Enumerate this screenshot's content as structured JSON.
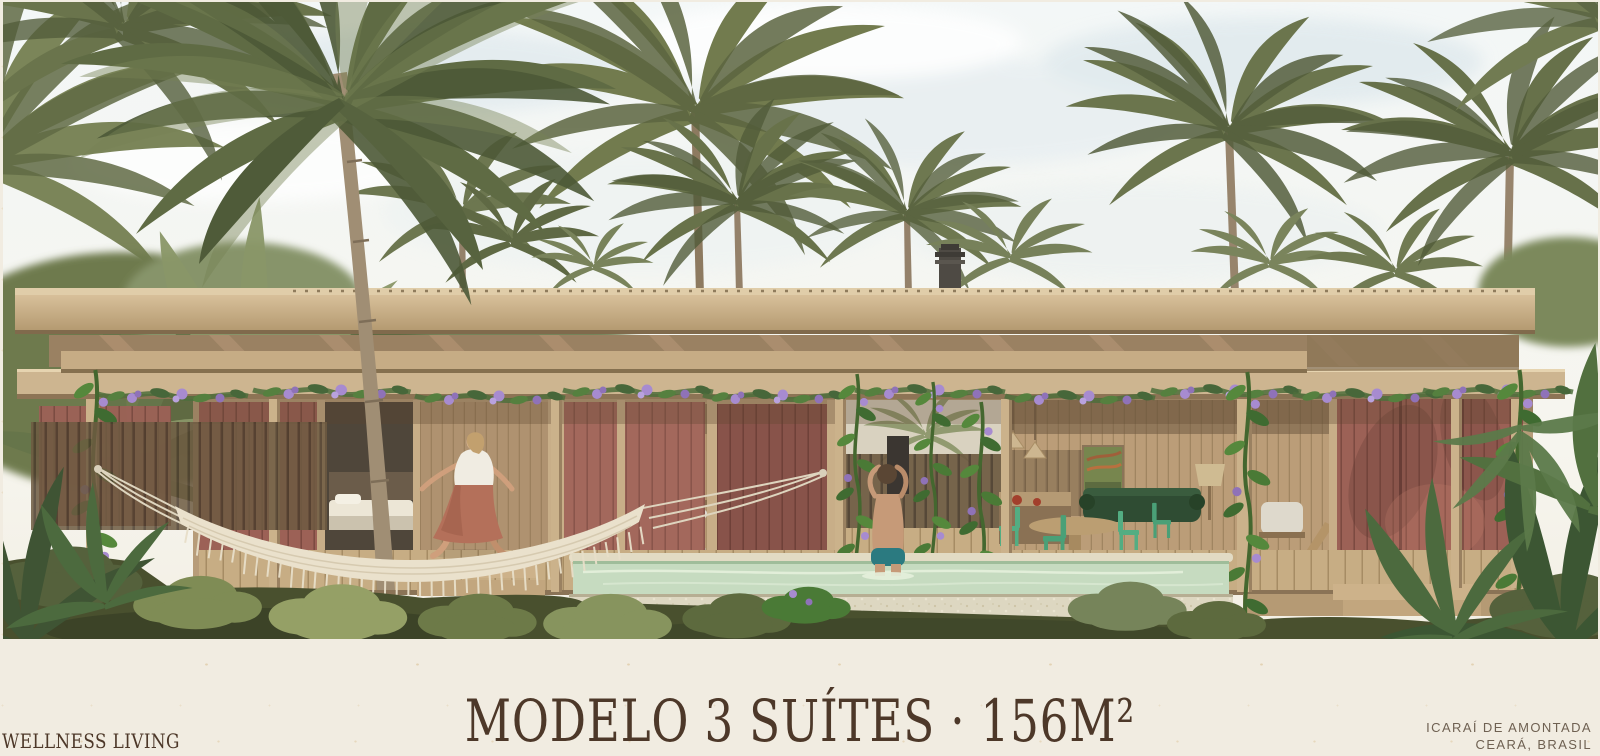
{
  "slide": {
    "title": "MODELO 3 SUÍTES · 156M²",
    "brand": "WELLNESS LIVING",
    "location": {
      "line1": "ICARAÍ DE AMONTADA",
      "line2": "CEARÁ, BRASIL"
    },
    "hero_alt": "Architectural rendering of a single-storey timber house with a flat pergola roof, terracotta sliding panels, flowering vines, a lap pool with a child bathing, a woman walking on the wooden deck, a white macrame hammock and coconut palms under a pale sky"
  },
  "colors": {
    "paper": "#f1ece1",
    "ink": "#4d3829",
    "ink-soft": "#6f6152",
    "sky": "#f5f8f7",
    "wood-light": "#d8c09a",
    "wood": "#c0a67f",
    "wood-dark": "#8f7758",
    "terracotta": "#9c6156",
    "terracotta-dark": "#7c4a41",
    "palm-olive": "#6d7750",
    "palm-dark": "#515c3a",
    "jungle": "#5e6a42",
    "grass": "#49502e",
    "pool-water": "#c6dbc0",
    "stone": "#ddd7c1",
    "vine-green": "#55803f",
    "flower-purple": "#a78bd0",
    "chair-green": "#53ad82",
    "sofa-green": "#2f4c33",
    "hammock": "#eae1cc"
  }
}
